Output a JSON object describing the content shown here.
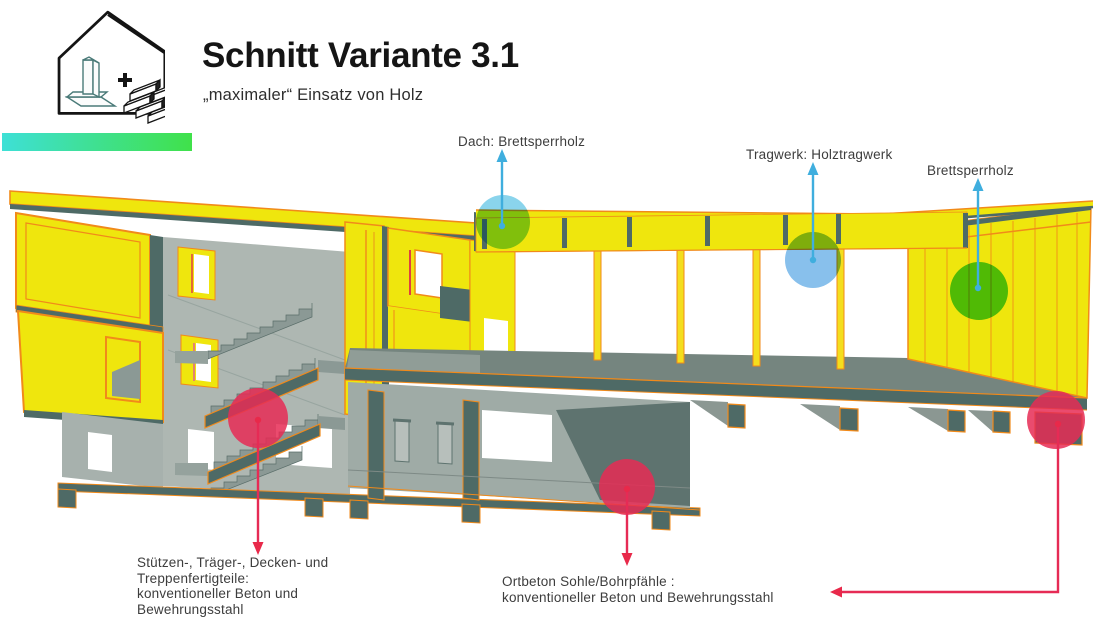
{
  "header": {
    "title": "Schnitt Variante 3.1",
    "subtitle": "„maximaler“ Einsatz von Holz"
  },
  "logo": {
    "icon": "house-with-concrete-element-plus-wood-beams-icon",
    "plus_sign": "+"
  },
  "legend_bar": {
    "type": "gradient-bar",
    "gradient_start": "#3EE0D6",
    "gradient_end": "#40E14A"
  },
  "annotations": {
    "dach": {
      "label": "Dach: Brettsperrholz",
      "marker_color": "#8AD4EC",
      "arrow_color": "#3FAEDE"
    },
    "tragwerk": {
      "label": "Tragwerk: Holztragwerk",
      "marker_color": "#88C0EC",
      "arrow_color": "#3FAEDE"
    },
    "brettsperrholz": {
      "label": "Brettsperrholz",
      "marker_color": "#55CE55",
      "arrow_color": "#3FAEDE"
    },
    "stuetzen": {
      "label": "Stützen-, Träger-, Decken- und\nTreppenfertigteile:\nkonventioneller Beton und\nBewehrungsstahl",
      "marker_color": "#E62B55",
      "arrow_color": "#E8294A"
    },
    "ortbeton": {
      "label": "Ortbeton Sohle/Bohrpfähle :\nkonventioneller Beton und Bewehrungsstahl",
      "marker_color": "#E62B55",
      "arrow_color": "#E8294A"
    }
  },
  "colors": {
    "wood": "#EFE60D",
    "orange": "#F18A1A",
    "teal": "#4E6A66",
    "cLight": "#AEB7B2",
    "cMid": "#8B9995",
    "slab": "#75857F",
    "red": "#E62B55",
    "cyan": "#3FAEDE",
    "grad1": "#3EE0D6",
    "grad2": "#40E14A"
  }
}
